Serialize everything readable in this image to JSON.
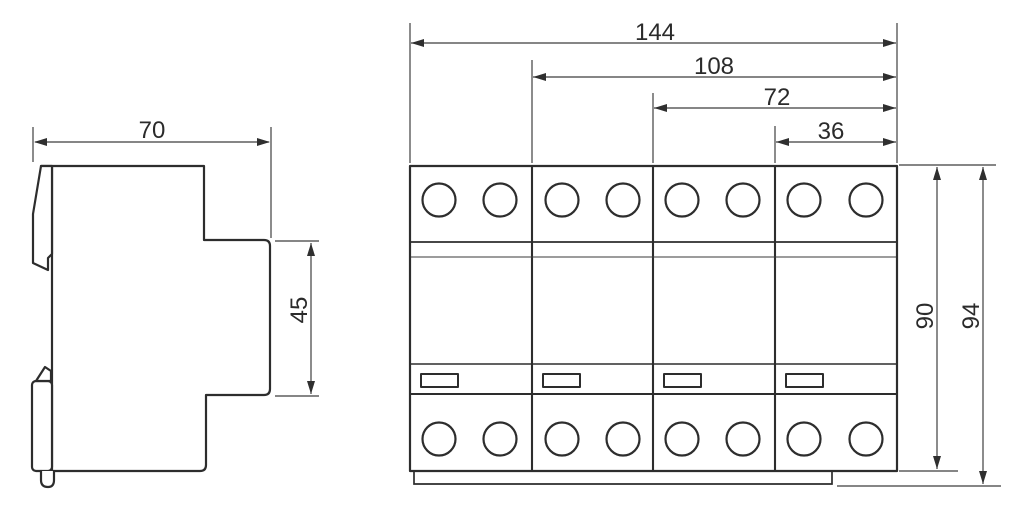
{
  "colors": {
    "object_line": "#2d2d2d",
    "dimension_line": "#3f3f3f",
    "text": "#2b2b2b",
    "background": "#ffffff"
  },
  "side_view": {
    "dimensions": {
      "width": {
        "value": "70"
      },
      "step_height": {
        "value": "45"
      }
    }
  },
  "front_view": {
    "module_count": 4,
    "terminal_circles_top": 8,
    "terminal_circles_bottom": 8,
    "label_windows": 4,
    "dimensions": {
      "overall_width": {
        "value": "144"
      },
      "width_three_modules": {
        "value": "108"
      },
      "width_two_modules": {
        "value": "72"
      },
      "width_one_module": {
        "value": "36"
      },
      "body_height": {
        "value": "90"
      },
      "overall_height": {
        "value": "94"
      }
    }
  }
}
